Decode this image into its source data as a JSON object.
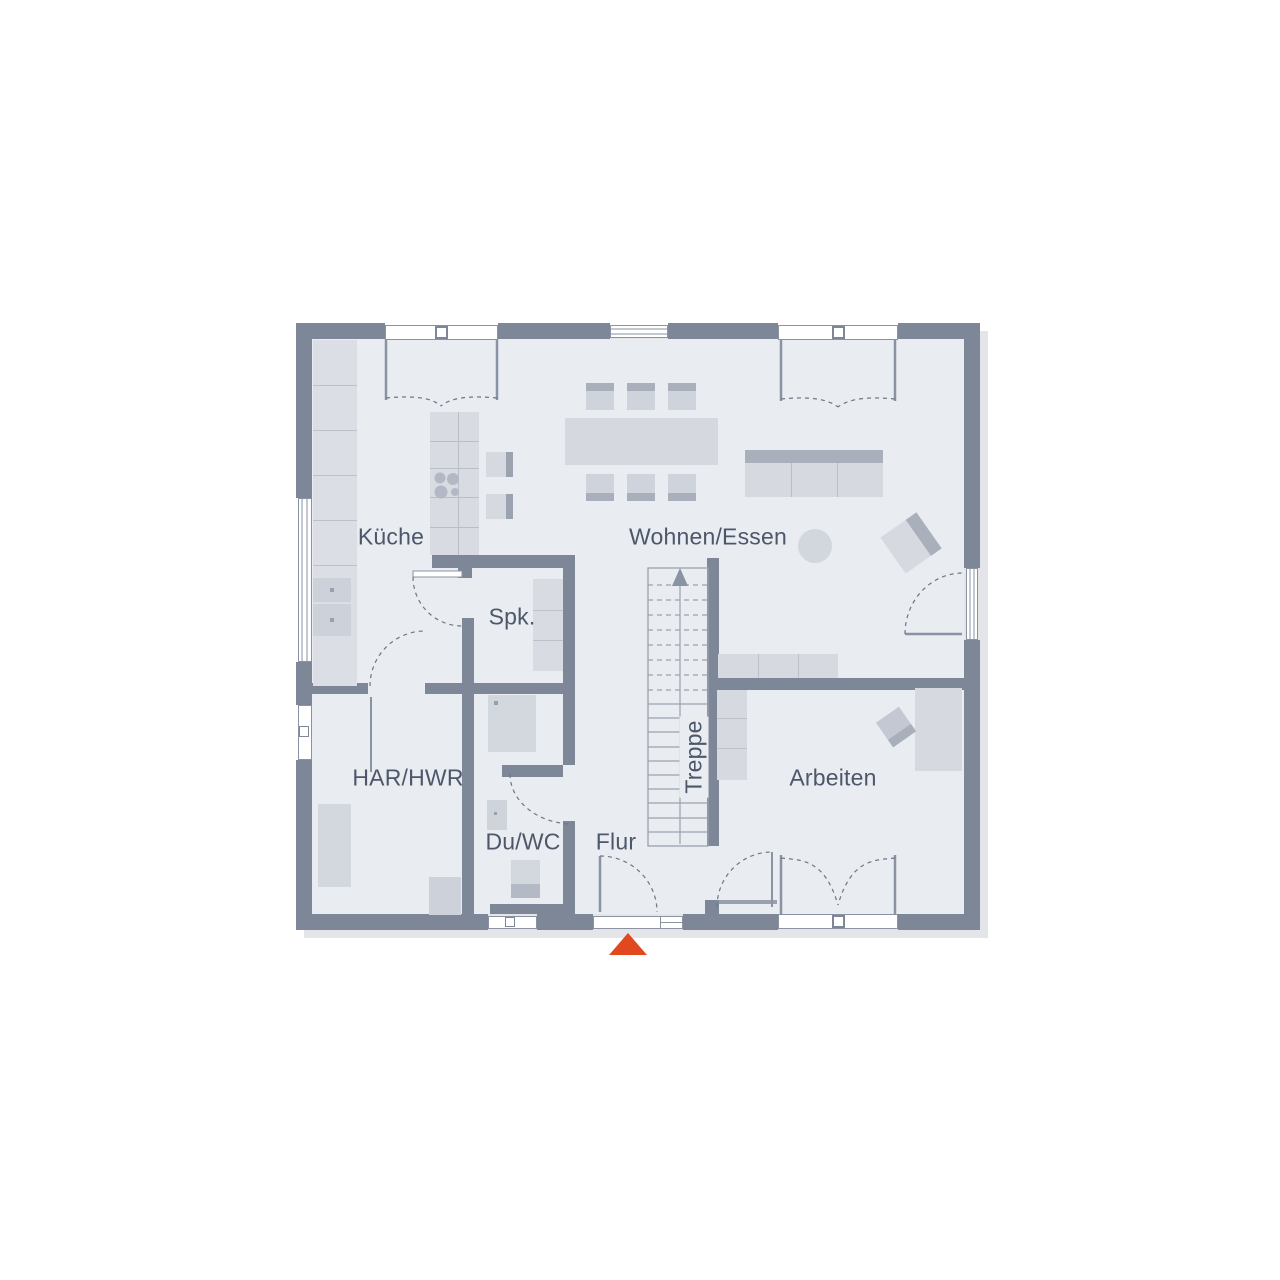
{
  "rooms": {
    "kueche": "Küche",
    "wohnen_essen": "Wohnen/Essen",
    "spk": "Spk.",
    "har_hwr": "HAR/HWR",
    "du_wc": "Du/WC",
    "flur": "Flur",
    "treppe": "Treppe",
    "arbeiten": "Arbeiten"
  },
  "colors": {
    "wall": "#7d8798",
    "floor": "#e9ecf1",
    "furniture_light": "#d6dae0",
    "furniture_dark": "#a9b0bc",
    "entrance_marker": "#e2481f",
    "label_text": "#4d576a"
  },
  "entrance_marker": {
    "shape": "triangle-up",
    "color": "#e2481f"
  }
}
